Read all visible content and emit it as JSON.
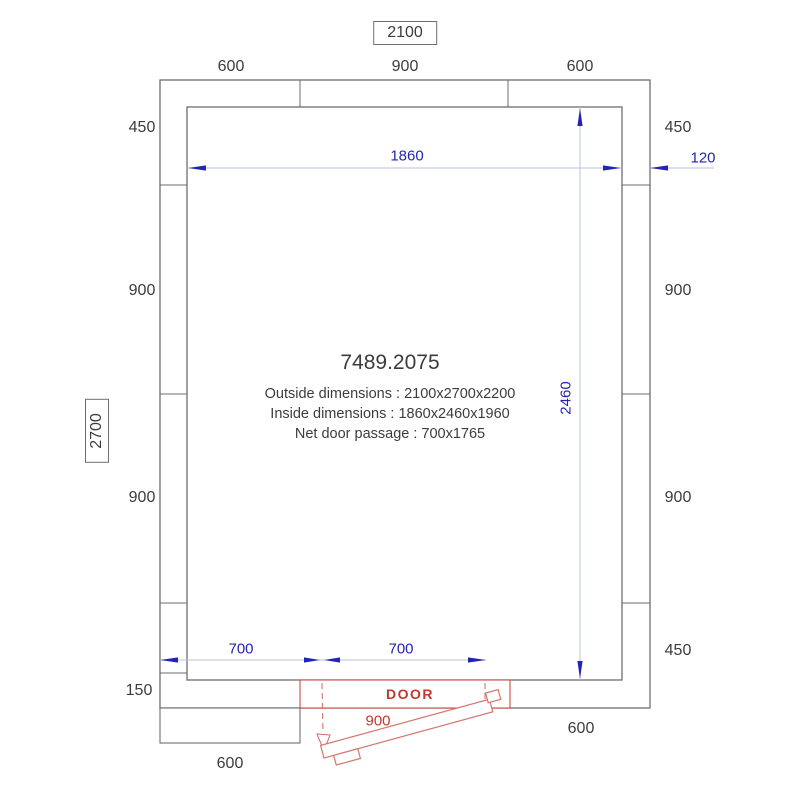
{
  "title_block": {
    "model": "7489.2075",
    "outside": "Outside dimensions : 2100x2700x2200",
    "inside": "Inside dimensions : 1860x2460x1960",
    "door_passage": "Net door passage : 700x1765"
  },
  "dimensions": {
    "overall_width": "2100",
    "overall_depth": "2700",
    "top": [
      "600",
      "900",
      "600"
    ],
    "left": [
      "450",
      "900",
      "900",
      "150"
    ],
    "right": [
      "450",
      "900",
      "900",
      "450"
    ],
    "inner_width": "1860",
    "inner_depth": "2460",
    "wall_thickness": "120",
    "bottom_inner": [
      "700",
      "700"
    ],
    "door_label": "DOOR",
    "door_width": "900",
    "bottom_left_panel": "600",
    "bottom_right_wall": "600"
  },
  "colors": {
    "wall_line": "#6e6e6e",
    "dim_text_blue": "#2424b4",
    "dim_line_light": "#b7bfdd",
    "door_frame_red": "#c0392b",
    "door_leaf_red": "#d4766e",
    "text_dark": "#3c3c3c"
  }
}
